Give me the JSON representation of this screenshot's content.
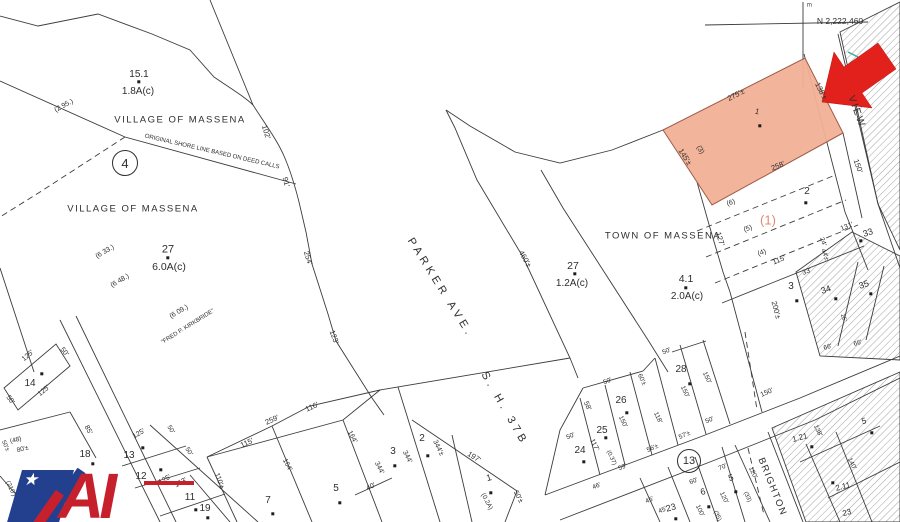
{
  "canvas": {
    "width": 900,
    "height": 522,
    "background": "#ffffff"
  },
  "colors": {
    "line": "#3c3c3c",
    "highlight_fill": "#f1b096",
    "highlight_stroke": "#9c5a48",
    "arrow_red": "#e3211c",
    "ref_red": "#e08a77",
    "teal_tick": "#3aaa9a",
    "logo_blue": "#23408f",
    "logo_red": "#c6202c"
  },
  "map": {
    "section_circles": [
      {
        "label": "4",
        "x": 125,
        "y": 163,
        "r": 12,
        "fs": 13
      },
      {
        "label": "13",
        "x": 689,
        "y": 461,
        "r": 11,
        "fs": 11
      }
    ],
    "labels": [
      {
        "t": "15.1",
        "x": 139,
        "y": 75,
        "s": 10
      },
      {
        "t": "1.8A(c)",
        "x": 138,
        "y": 92,
        "s": 10
      },
      {
        "t": "VILLAGE OF MASSENA",
        "x": 180,
        "y": 120,
        "s": 9.5,
        "sp": 1.5
      },
      {
        "t": "(2 95.)",
        "x": 64,
        "y": 106,
        "r": -28,
        "s": 7
      },
      {
        "t": "ORIGINAL SHORE LINE BASED ON DEED CALLS",
        "x": 212,
        "y": 152,
        "r": 13,
        "s": 6
      },
      {
        "t": "102'",
        "x": 266,
        "y": 132,
        "r": 72,
        "s": 7.5
      },
      {
        "t": "91'",
        "x": 286,
        "y": 182,
        "r": 75,
        "s": 7.5
      },
      {
        "t": "VILLAGE OF MASSENA",
        "x": 133,
        "y": 209,
        "s": 9.5,
        "sp": 1.5
      },
      {
        "t": "(6 33.)",
        "x": 105,
        "y": 252,
        "r": -30,
        "s": 7
      },
      {
        "t": "27",
        "x": 168,
        "y": 250,
        "s": 11
      },
      {
        "t": "6.0A(c)",
        "x": 169,
        "y": 267,
        "s": 10.5
      },
      {
        "t": "(6 48.)",
        "x": 120,
        "y": 281,
        "r": -30,
        "s": 7
      },
      {
        "t": "(6 09.)",
        "x": 179,
        "y": 312,
        "r": -30,
        "s": 7
      },
      {
        "t": "\"FRED P. KIRKBRIDE\"",
        "x": 188,
        "y": 327,
        "r": -32,
        "s": 6
      },
      {
        "t": "254'",
        "x": 308,
        "y": 258,
        "r": 72,
        "s": 7.5
      },
      {
        "t": "123'",
        "x": 334,
        "y": 337,
        "r": 70,
        "s": 7.5
      },
      {
        "t": "PARKER  AVE.",
        "x": 440,
        "y": 288,
        "r": 58,
        "s": 11,
        "sp": 4
      },
      {
        "t": "460'±",
        "x": 525,
        "y": 259,
        "r": 60,
        "s": 7.5
      },
      {
        "t": "27",
        "x": 573,
        "y": 266,
        "s": 10.5
      },
      {
        "t": "1.2A(c)",
        "x": 572,
        "y": 284,
        "s": 10
      },
      {
        "t": "TOWN OF MASSENA",
        "x": 663,
        "y": 236,
        "s": 9.5,
        "sp": 1.5
      },
      {
        "t": "4.1",
        "x": 686,
        "y": 279,
        "s": 10.5
      },
      {
        "t": "2.0A(c)",
        "x": 687,
        "y": 297,
        "s": 10
      },
      {
        "t": "S. H.  37B",
        "x": 504,
        "y": 409,
        "r": 60,
        "s": 11,
        "sp": 4
      },
      {
        "t": "N 2,222,460",
        "x": 840,
        "y": 21,
        "s": 8.5
      },
      {
        "t": "E",
        "x": 808,
        "y": 5,
        "r": 90,
        "s": 6
      },
      {
        "t": "275'±",
        "x": 736,
        "y": 95,
        "r": -27,
        "s": 7.5
      },
      {
        "t": "138'±",
        "x": 821,
        "y": 91,
        "r": 63,
        "s": 7.5
      },
      {
        "t": "145'±",
        "x": 685,
        "y": 157,
        "r": 57,
        "s": 7.5
      },
      {
        "t": "258'",
        "x": 778,
        "y": 166,
        "r": -22,
        "s": 7.5
      },
      {
        "t": "(3)",
        "x": 700,
        "y": 150,
        "r": 60,
        "s": 7
      },
      {
        "t": "1",
        "x": 757,
        "y": 112,
        "r": 15,
        "s": 8
      },
      {
        "t": "VIEW",
        "x": 856,
        "y": 112,
        "r": 70,
        "s": 10,
        "sp": 2
      },
      {
        "t": "150'",
        "x": 858,
        "y": 166,
        "r": 70,
        "s": 7.5
      },
      {
        "t": "2",
        "x": 807,
        "y": 192,
        "s": 10
      },
      {
        "t": "(1)",
        "x": 768,
        "y": 220,
        "s": 13,
        "c": "ref"
      },
      {
        "t": "(6)",
        "x": 731,
        "y": 203,
        "r": -20,
        "s": 7
      },
      {
        "t": "(5)",
        "x": 748,
        "y": 229,
        "r": -20,
        "s": 7
      },
      {
        "t": "(4)",
        "x": 762,
        "y": 253,
        "r": -20,
        "s": 7
      },
      {
        "t": "127'",
        "x": 720,
        "y": 239,
        "r": 72,
        "s": 7.5
      },
      {
        "t": "115'",
        "x": 779,
        "y": 260,
        "r": -22,
        "s": 7.5
      },
      {
        "t": "3",
        "x": 791,
        "y": 287,
        "s": 10
      },
      {
        "t": "200'±",
        "x": 776,
        "y": 310,
        "r": 75,
        "s": 7.5
      },
      {
        "t": "131'",
        "x": 847,
        "y": 227,
        "r": -22,
        "s": 7
      },
      {
        "t": "33",
        "x": 868,
        "y": 233,
        "r": -20,
        "s": 9
      },
      {
        "t": "24'",
        "x": 822,
        "y": 242,
        "r": 70,
        "s": 6.5
      },
      {
        "t": "44'±",
        "x": 824,
        "y": 255,
        "r": 70,
        "s": 6.5
      },
      {
        "t": "33'",
        "x": 807,
        "y": 272,
        "r": -20,
        "s": 7
      },
      {
        "t": "34",
        "x": 826,
        "y": 290,
        "r": -20,
        "s": 9
      },
      {
        "t": "35",
        "x": 864,
        "y": 285,
        "r": -20,
        "s": 9
      },
      {
        "t": "66'",
        "x": 828,
        "y": 348,
        "r": -15,
        "s": 6.5
      },
      {
        "t": "66'",
        "x": 858,
        "y": 344,
        "r": -15,
        "s": 6.5
      },
      {
        "t": "26'",
        "x": 843,
        "y": 318,
        "r": 70,
        "s": 6
      },
      {
        "t": "14",
        "x": 30,
        "y": 384,
        "s": 10
      },
      {
        "t": "125'",
        "x": 28,
        "y": 356,
        "r": -40,
        "s": 7
      },
      {
        "t": "125'",
        "x": 44,
        "y": 391,
        "r": -40,
        "s": 7
      },
      {
        "t": "50'",
        "x": 64,
        "y": 352,
        "r": 52,
        "s": 7
      },
      {
        "t": "50'",
        "x": 10,
        "y": 400,
        "r": 52,
        "s": 7
      },
      {
        "t": "(48)",
        "x": 16,
        "y": 441,
        "r": -15,
        "s": 6.5
      },
      {
        "t": "80'±",
        "x": 23,
        "y": 450,
        "r": -15,
        "s": 6.5
      },
      {
        "t": "50'±",
        "x": 5,
        "y": 446,
        "r": 65,
        "s": 6
      },
      {
        "t": "(210')",
        "x": 10,
        "y": 489,
        "r": 65,
        "s": 6.5
      },
      {
        "t": "18",
        "x": 85,
        "y": 455,
        "s": 10
      },
      {
        "t": "85'",
        "x": 88,
        "y": 430,
        "r": 62,
        "s": 7
      },
      {
        "t": "19",
        "x": 205,
        "y": 509,
        "s": 10
      },
      {
        "t": "13",
        "x": 129,
        "y": 456,
        "s": 10
      },
      {
        "t": "125'",
        "x": 139,
        "y": 434,
        "r": -30,
        "s": 7
      },
      {
        "t": "12",
        "x": 141,
        "y": 477,
        "s": 10
      },
      {
        "t": "125'",
        "x": 165,
        "y": 480,
        "r": -30,
        "s": 7
      },
      {
        "t": "153'",
        "x": 181,
        "y": 483,
        "r": -30,
        "s": 7
      },
      {
        "t": "50'",
        "x": 170,
        "y": 430,
        "r": 58,
        "s": 6.5
      },
      {
        "t": "50'",
        "x": 188,
        "y": 452,
        "r": 58,
        "s": 6.5
      },
      {
        "t": "11",
        "x": 190,
        "y": 498,
        "s": 10
      },
      {
        "t": "110'±",
        "x": 219,
        "y": 481,
        "r": 70,
        "s": 7
      },
      {
        "t": "259'",
        "x": 272,
        "y": 420,
        "r": -24,
        "s": 7.5
      },
      {
        "t": "116'",
        "x": 312,
        "y": 407,
        "r": -24,
        "s": 7.5
      },
      {
        "t": "115'",
        "x": 247,
        "y": 443,
        "r": -24,
        "s": 7.5
      },
      {
        "t": "164'",
        "x": 287,
        "y": 465,
        "r": 62,
        "s": 7
      },
      {
        "t": "164'",
        "x": 352,
        "y": 437,
        "r": 62,
        "s": 7
      },
      {
        "t": "7",
        "x": 268,
        "y": 501,
        "s": 10
      },
      {
        "t": "5",
        "x": 336,
        "y": 489,
        "s": 10
      },
      {
        "t": "344'",
        "x": 379,
        "y": 468,
        "r": 64,
        "s": 7
      },
      {
        "t": "40'",
        "x": 371,
        "y": 487,
        "r": -22,
        "s": 7
      },
      {
        "t": "3",
        "x": 393,
        "y": 452,
        "s": 10
      },
      {
        "t": "344'",
        "x": 407,
        "y": 457,
        "r": 64,
        "s": 7
      },
      {
        "t": "2",
        "x": 422,
        "y": 439,
        "s": 10
      },
      {
        "t": "344'±",
        "x": 438,
        "y": 448,
        "r": 64,
        "s": 7
      },
      {
        "t": "197'",
        "x": 474,
        "y": 457,
        "r": 32,
        "s": 7.5
      },
      {
        "t": "1",
        "x": 489,
        "y": 478,
        "r": -15,
        "s": 9
      },
      {
        "t": "(0.2A)",
        "x": 486,
        "y": 502,
        "r": 62,
        "s": 6.5
      },
      {
        "t": "50'±",
        "x": 518,
        "y": 497,
        "r": 62,
        "s": 7
      },
      {
        "t": "24",
        "x": 580,
        "y": 451,
        "s": 10
      },
      {
        "t": "50'",
        "x": 571,
        "y": 437,
        "r": -24,
        "s": 6.5
      },
      {
        "t": "58'",
        "x": 587,
        "y": 406,
        "r": 65,
        "s": 7
      },
      {
        "t": "117'",
        "x": 594,
        "y": 445,
        "r": 65,
        "s": 7
      },
      {
        "t": "(0.37)",
        "x": 611,
        "y": 458,
        "r": 65,
        "s": 6
      },
      {
        "t": "46'",
        "x": 597,
        "y": 487,
        "r": -24,
        "s": 6.5
      },
      {
        "t": "59'",
        "x": 623,
        "y": 468,
        "r": -24,
        "s": 6.5
      },
      {
        "t": "25",
        "x": 602,
        "y": 431,
        "s": 10
      },
      {
        "t": "26",
        "x": 621,
        "y": 401,
        "s": 10
      },
      {
        "t": "50'",
        "x": 608,
        "y": 382,
        "r": -24,
        "s": 6.5
      },
      {
        "t": "60'±",
        "x": 641,
        "y": 380,
        "r": 65,
        "s": 6.5
      },
      {
        "t": "150'",
        "x": 622,
        "y": 422,
        "r": 65,
        "s": 6.5
      },
      {
        "t": "118'",
        "x": 657,
        "y": 418,
        "r": 65,
        "s": 6.5
      },
      {
        "t": "56'±",
        "x": 653,
        "y": 449,
        "r": -24,
        "s": 6.5
      },
      {
        "t": "57'±",
        "x": 685,
        "y": 436,
        "r": -24,
        "s": 6.5
      },
      {
        "t": "50'",
        "x": 710,
        "y": 421,
        "r": -24,
        "s": 6.5
      },
      {
        "t": "28",
        "x": 681,
        "y": 370,
        "s": 10
      },
      {
        "t": "50'",
        "x": 667,
        "y": 352,
        "r": -24,
        "s": 6.5
      },
      {
        "t": "150'",
        "x": 706,
        "y": 378,
        "r": 65,
        "s": 6.5
      },
      {
        "t": "150'",
        "x": 684,
        "y": 392,
        "r": 65,
        "s": 6.5
      },
      {
        "t": "150'",
        "x": 767,
        "y": 393,
        "r": -24,
        "s": 7
      },
      {
        "t": "45'",
        "x": 650,
        "y": 501,
        "r": -24,
        "s": 6.5
      },
      {
        "t": "45'",
        "x": 663,
        "y": 511,
        "r": -24,
        "s": 6.5
      },
      {
        "t": "23",
        "x": 671,
        "y": 508,
        "r": -15,
        "s": 9
      },
      {
        "t": "60'",
        "x": 694,
        "y": 482,
        "r": -24,
        "s": 6.5
      },
      {
        "t": "6",
        "x": 703,
        "y": 492,
        "r": -15,
        "s": 9
      },
      {
        "t": "100'",
        "x": 699,
        "y": 511,
        "r": 65,
        "s": 6.5
      },
      {
        "t": "70'",
        "x": 723,
        "y": 468,
        "r": -24,
        "s": 6.5
      },
      {
        "t": "5",
        "x": 731,
        "y": 478,
        "r": -15,
        "s": 9
      },
      {
        "t": "120'",
        "x": 723,
        "y": 498,
        "r": 65,
        "s": 6.5
      },
      {
        "t": "(33)",
        "x": 747,
        "y": 497,
        "r": 65,
        "s": 6
      },
      {
        "t": "(35)",
        "x": 717,
        "y": 516,
        "r": 65,
        "s": 6
      },
      {
        "t": "120'",
        "x": 752,
        "y": 473,
        "r": 65,
        "s": 6.5
      },
      {
        "t": "BRIGHTON",
        "x": 772,
        "y": 487,
        "r": 68,
        "s": 9.5,
        "sp": 1.5
      },
      {
        "t": "1.21",
        "x": 800,
        "y": 438,
        "r": -15,
        "s": 8
      },
      {
        "t": "138'",
        "x": 817,
        "y": 431,
        "r": 65,
        "s": 6.5
      },
      {
        "t": "2.11",
        "x": 843,
        "y": 487,
        "r": -15,
        "s": 8
      },
      {
        "t": "140'",
        "x": 851,
        "y": 464,
        "r": 65,
        "s": 6.5
      },
      {
        "t": "5",
        "x": 864,
        "y": 421,
        "r": -15,
        "s": 8.5
      },
      {
        "t": "23",
        "x": 847,
        "y": 513,
        "r": -15,
        "s": 8
      }
    ],
    "dots": [
      {
        "x": 139,
        "y": 82
      },
      {
        "x": 168,
        "y": 258
      },
      {
        "x": 575,
        "y": 274
      },
      {
        "x": 686,
        "y": 288
      },
      {
        "x": 760,
        "y": 126
      },
      {
        "x": 806,
        "y": 203
      },
      {
        "x": 797,
        "y": 301
      },
      {
        "x": 861,
        "y": 241
      },
      {
        "x": 836,
        "y": 299
      },
      {
        "x": 871,
        "y": 294
      },
      {
        "x": 42,
        "y": 374
      },
      {
        "x": 93,
        "y": 464
      },
      {
        "x": 208,
        "y": 518
      },
      {
        "x": 143,
        "y": 448
      },
      {
        "x": 161,
        "y": 470
      },
      {
        "x": 196,
        "y": 510
      },
      {
        "x": 273,
        "y": 514
      },
      {
        "x": 340,
        "y": 503
      },
      {
        "x": 395,
        "y": 466
      },
      {
        "x": 428,
        "y": 456
      },
      {
        "x": 491,
        "y": 493
      },
      {
        "x": 584,
        "y": 462
      },
      {
        "x": 606,
        "y": 438
      },
      {
        "x": 627,
        "y": 413
      },
      {
        "x": 690,
        "y": 384
      },
      {
        "x": 676,
        "y": 519
      },
      {
        "x": 709,
        "y": 507
      },
      {
        "x": 736,
        "y": 492
      },
      {
        "x": 812,
        "y": 447
      },
      {
        "x": 833,
        "y": 483
      },
      {
        "x": 872,
        "y": 433
      }
    ]
  },
  "logo": {
    "text": "AI"
  }
}
